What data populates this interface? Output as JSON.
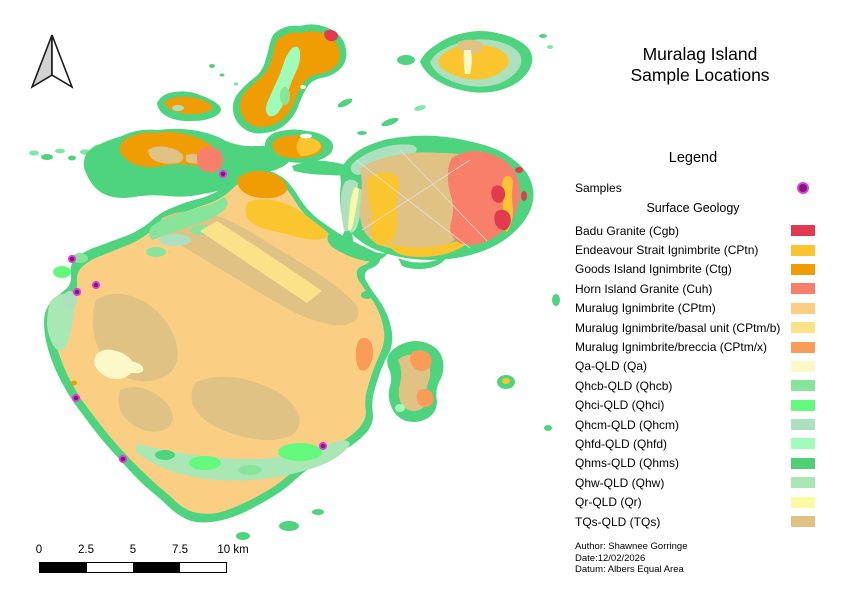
{
  "title": {
    "line1": "Muralag Island",
    "line2": "Sample Locations"
  },
  "legend": {
    "heading": "Legend",
    "samples_label": "Samples",
    "group_heading": "Surface Geology",
    "sample_marker": {
      "center_color": "#7a1a7d",
      "ring_color": "#e73cdf"
    },
    "items": [
      {
        "label": "Badu Granite (Cgb)",
        "color": "#e23b50"
      },
      {
        "label": "Endeavour Strait Ignimbrite (CPtn)",
        "color": "#fbc52f"
      },
      {
        "label": "Goods Island Ignimbrite (Ctg)",
        "color": "#f09d04"
      },
      {
        "label": "Horn Island Granite (Cuh)",
        "color": "#f8806a"
      },
      {
        "label": "Muralug Ignimbrite (CPtm)",
        "color": "#facf84"
      },
      {
        "label": "Muralug Ignimbrite/basal unit (CPtm/b)",
        "color": "#fbe289"
      },
      {
        "label": "Muralug Ignimbrite/breccia (CPtm/x)",
        "color": "#fa9b57"
      },
      {
        "label": "Qa-QLD (Qa)",
        "color": "#fcf8c8"
      },
      {
        "label": "Qhcb-QLD (Qhcb)",
        "color": "#86e59a"
      },
      {
        "label": "Qhci-QLD (Qhci)",
        "color": "#63f97d"
      },
      {
        "label": "Qhcm-QLD (Qhcm)",
        "color": "#ace0be"
      },
      {
        "label": "Qhfd-QLD (Qhfd)",
        "color": "#a0fcb9"
      },
      {
        "label": "Qhms-QLD (Qhms)",
        "color": "#4ed176"
      },
      {
        "label": "Qhw-QLD (Qhw)",
        "color": "#a9e8b5"
      },
      {
        "label": "Qr-QLD (Qr)",
        "color": "#fbfaa2"
      },
      {
        "label": "TQs-QLD (TQs)",
        "color": "#e0c285"
      }
    ]
  },
  "scalebar": {
    "labels": [
      {
        "label": "0",
        "x": 0
      },
      {
        "label": "2.5",
        "x": 47
      },
      {
        "label": "5",
        "x": 94
      },
      {
        "label": "7.5",
        "x": 141
      },
      {
        "label": "10 km",
        "x": 194
      }
    ]
  },
  "credits": {
    "author": "Author: Shawnee Gorringe",
    "date": "Date:12/02/2026",
    "datum": "Datum: Albers Equal Area"
  },
  "map": {
    "sample_points": [
      [
        223,
        174
      ],
      [
        72,
        259
      ],
      [
        96,
        285
      ],
      [
        77,
        292
      ],
      [
        76,
        398
      ],
      [
        123,
        459
      ],
      [
        323,
        446
      ]
    ]
  }
}
